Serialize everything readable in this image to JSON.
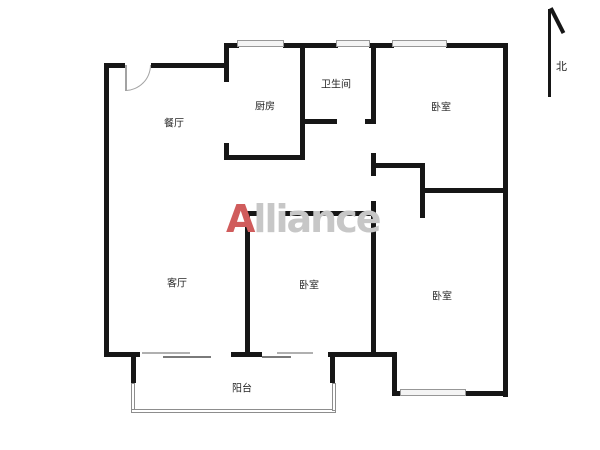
{
  "page": {
    "background": "#ffffff"
  },
  "colors": {
    "wall": "#161616",
    "window_fill": "#f4f4f4",
    "window_border": "#979797",
    "door": "#a3a3a3",
    "railing": "#8d8d8d",
    "label": "#262626",
    "watermark_gray": "#c7c7c7",
    "watermark_red": "#d05c5c"
  },
  "watermark": {
    "first_letter": "A",
    "rest": "lliance"
  },
  "compass": {
    "label": "北"
  },
  "rooms": [
    {
      "name": "dining-room",
      "label": "餐厅",
      "cx": 174,
      "cy": 122
    },
    {
      "name": "kitchen",
      "label": "厨房",
      "cx": 265,
      "cy": 105
    },
    {
      "name": "bathroom",
      "label": "卫生间",
      "cx": 336,
      "cy": 83
    },
    {
      "name": "bedroom-north",
      "label": "卧室",
      "cx": 441,
      "cy": 106
    },
    {
      "name": "living-room",
      "label": "客厅",
      "cx": 177,
      "cy": 282
    },
    {
      "name": "bedroom-middle",
      "label": "卧室",
      "cx": 309,
      "cy": 284
    },
    {
      "name": "bedroom-south",
      "label": "卧室",
      "cx": 442,
      "cy": 295
    },
    {
      "name": "balcony",
      "label": "阳台",
      "cx": 242,
      "cy": 387
    }
  ],
  "floorplan": {
    "walls": [
      {
        "x": 104,
        "y": 63,
        "w": 21,
        "h": 5
      },
      {
        "x": 151,
        "y": 63,
        "w": 78,
        "h": 5
      },
      {
        "x": 104,
        "y": 63,
        "w": 5,
        "h": 294
      },
      {
        "x": 224,
        "y": 43,
        "w": 5,
        "h": 39
      },
      {
        "x": 224,
        "y": 43,
        "w": 15,
        "h": 5
      },
      {
        "x": 283,
        "y": 43,
        "w": 55,
        "h": 5
      },
      {
        "x": 369,
        "y": 43,
        "w": 25,
        "h": 5
      },
      {
        "x": 446,
        "y": 43,
        "w": 62,
        "h": 5
      },
      {
        "x": 503,
        "y": 43,
        "w": 5,
        "h": 354
      },
      {
        "x": 224,
        "y": 143,
        "w": 5,
        "h": 17
      },
      {
        "x": 224,
        "y": 155,
        "w": 81,
        "h": 5
      },
      {
        "x": 300,
        "y": 43,
        "w": 5,
        "h": 117
      },
      {
        "x": 300,
        "y": 119,
        "w": 37,
        "h": 5
      },
      {
        "x": 365,
        "y": 119,
        "w": 11,
        "h": 5
      },
      {
        "x": 371,
        "y": 43,
        "w": 5,
        "h": 80
      },
      {
        "x": 371,
        "y": 153,
        "w": 5,
        "h": 23
      },
      {
        "x": 371,
        "y": 163,
        "w": 54,
        "h": 5
      },
      {
        "x": 420,
        "y": 163,
        "w": 5,
        "h": 55
      },
      {
        "x": 420,
        "y": 188,
        "w": 88,
        "h": 5
      },
      {
        "x": 245,
        "y": 211,
        "w": 14,
        "h": 5
      },
      {
        "x": 279,
        "y": 211,
        "w": 97,
        "h": 5
      },
      {
        "x": 245,
        "y": 211,
        "w": 5,
        "h": 146
      },
      {
        "x": 371,
        "y": 201,
        "w": 5,
        "h": 156
      },
      {
        "x": 104,
        "y": 352,
        "w": 36,
        "h": 5
      },
      {
        "x": 231,
        "y": 352,
        "w": 31,
        "h": 5
      },
      {
        "x": 328,
        "y": 352,
        "w": 69,
        "h": 5
      },
      {
        "x": 131,
        "y": 352,
        "w": 5,
        "h": 31
      },
      {
        "x": 330,
        "y": 352,
        "w": 5,
        "h": 31
      },
      {
        "x": 392,
        "y": 352,
        "w": 5,
        "h": 44
      },
      {
        "x": 395,
        "y": 391,
        "w": 8,
        "h": 5
      },
      {
        "x": 465,
        "y": 391,
        "w": 43,
        "h": 5
      }
    ],
    "windows": [
      {
        "x": 237,
        "y": 40,
        "w": 47,
        "h": 7
      },
      {
        "x": 336,
        "y": 40,
        "w": 34,
        "h": 7
      },
      {
        "x": 392,
        "y": 40,
        "w": 55,
        "h": 7
      },
      {
        "x": 400,
        "y": 389,
        "w": 66,
        "h": 7
      }
    ],
    "sliding_panels": [
      {
        "x": 142,
        "y": 352,
        "w": 48,
        "h": 2,
        "color": "#b0b0b0"
      },
      {
        "x": 163,
        "y": 356,
        "w": 48,
        "h": 2,
        "color": "#7a7a7a"
      },
      {
        "x": 277,
        "y": 352,
        "w": 36,
        "h": 2,
        "color": "#b0b0b0"
      },
      {
        "x": 262,
        "y": 356,
        "w": 29,
        "h": 2,
        "color": "#7a7a7a"
      }
    ],
    "railings": [
      {
        "x": 131,
        "y": 383,
        "w": 4,
        "h": 28
      },
      {
        "x": 131,
        "y": 409,
        "w": 205,
        "h": 4
      },
      {
        "x": 332,
        "y": 383,
        "w": 4,
        "h": 28
      }
    ],
    "door": {
      "x": 125,
      "y": 65,
      "size": 26
    }
  }
}
